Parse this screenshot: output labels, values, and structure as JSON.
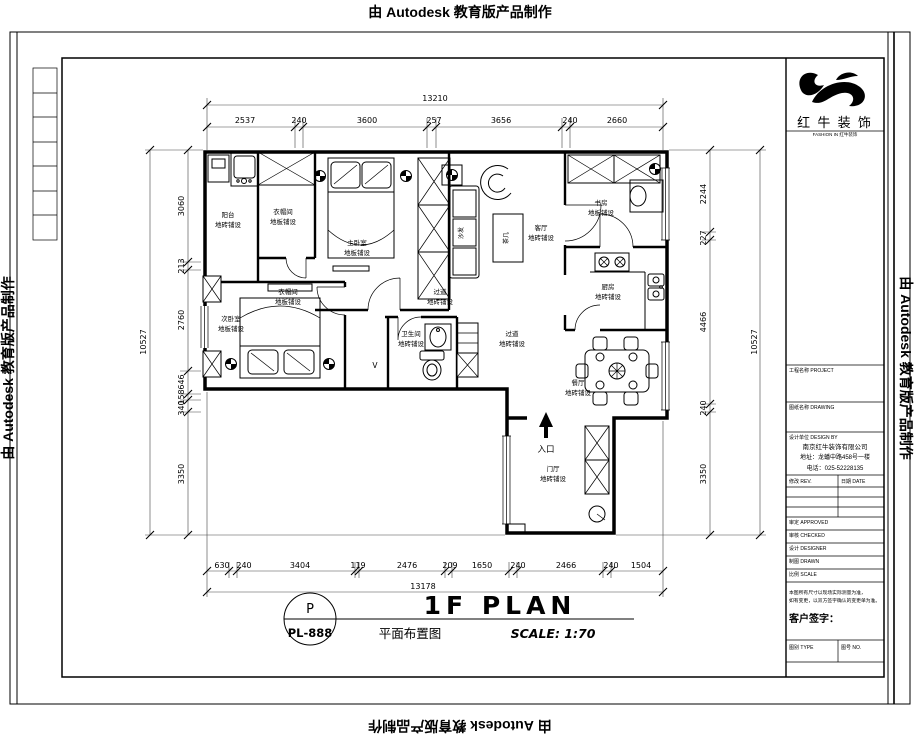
{
  "watermark": {
    "text": "由 Autodesk 教育版产品制作"
  },
  "sheet": {
    "circle_letter": "P",
    "sheet_number": "PL-888",
    "title_en": "1F PLAN",
    "title_cn": "平面布置图",
    "scale_label": "SCALE: 1:70"
  },
  "plan": {
    "entry_label": "入口",
    "drain_label": "V",
    "furniture_labels": {
      "sofa": "沙发",
      "tea_table": "茶几"
    },
    "rooms": [
      {
        "name": "阳台",
        "finish": "地砖铺设"
      },
      {
        "name": "衣帽间",
        "finish": "地板铺设"
      },
      {
        "name": "主卧室",
        "finish": "地板铺设"
      },
      {
        "name": "衣帽间",
        "finish": "地板铺设"
      },
      {
        "name": "次卧室",
        "finish": "地板铺设"
      },
      {
        "name": "书房",
        "finish": "地板铺设"
      },
      {
        "name": "客厅",
        "finish": "地砖铺设"
      },
      {
        "name": "厨房",
        "finish": "地砖铺设"
      },
      {
        "name": "过道",
        "finish": "地砖铺设"
      },
      {
        "name": "卫生间",
        "finish": "地砖铺设"
      },
      {
        "name": "过道",
        "finish": "地砖铺设"
      },
      {
        "name": "餐厅",
        "finish": "地砖铺设"
      },
      {
        "name": "门厅",
        "finish": "地砖铺设"
      }
    ]
  },
  "dims": {
    "top_total": "13210",
    "top": [
      "2537",
      "240",
      "3600",
      "257",
      "3656",
      "240",
      "2660"
    ],
    "bottom_total": "13178",
    "bottom": [
      "630",
      "240",
      "3404",
      "119",
      "2476",
      "209",
      "1650",
      "240",
      "2466",
      "240",
      "1504"
    ],
    "left_total": "10527",
    "left": [
      "3060",
      "213",
      "2760",
      "646",
      "158",
      "340",
      "3350"
    ],
    "right_total": "10527",
    "right": [
      "2244",
      "227",
      "4466",
      "240",
      "3350"
    ]
  },
  "title_block": {
    "company_name": "红 牛 装 饰",
    "tagline": "FASHION IN 红牛装饰",
    "fields": {
      "project_label": "工程名称 PROJECT",
      "drawing_label": "图纸名称 DRAWING",
      "design_by_label": "设计单位 DESIGN BY",
      "company_line1": "南京红牛装饰有限公司",
      "company_line2": "地址：龙蟠中路458号一楼",
      "company_line3": "电话：025-52228135",
      "rev_label": "修改 REV.",
      "date_col_label": "日期 DATE",
      "row1": "审定 APPROVED",
      "row2": "审核 CHECKED",
      "row3": "设计 DESIGNER",
      "row4": "制图 DRAWN",
      "row5": "比例 SCALE",
      "note_line1": "本图所有尺寸以现场实际测量为准，",
      "note_line2": "如有变更，以双方签字确认的变更单为准。",
      "sign_label": "客户签字：",
      "bottom_left_label": "图别 TYPE",
      "bottom_right_label": "图号 NO."
    }
  }
}
